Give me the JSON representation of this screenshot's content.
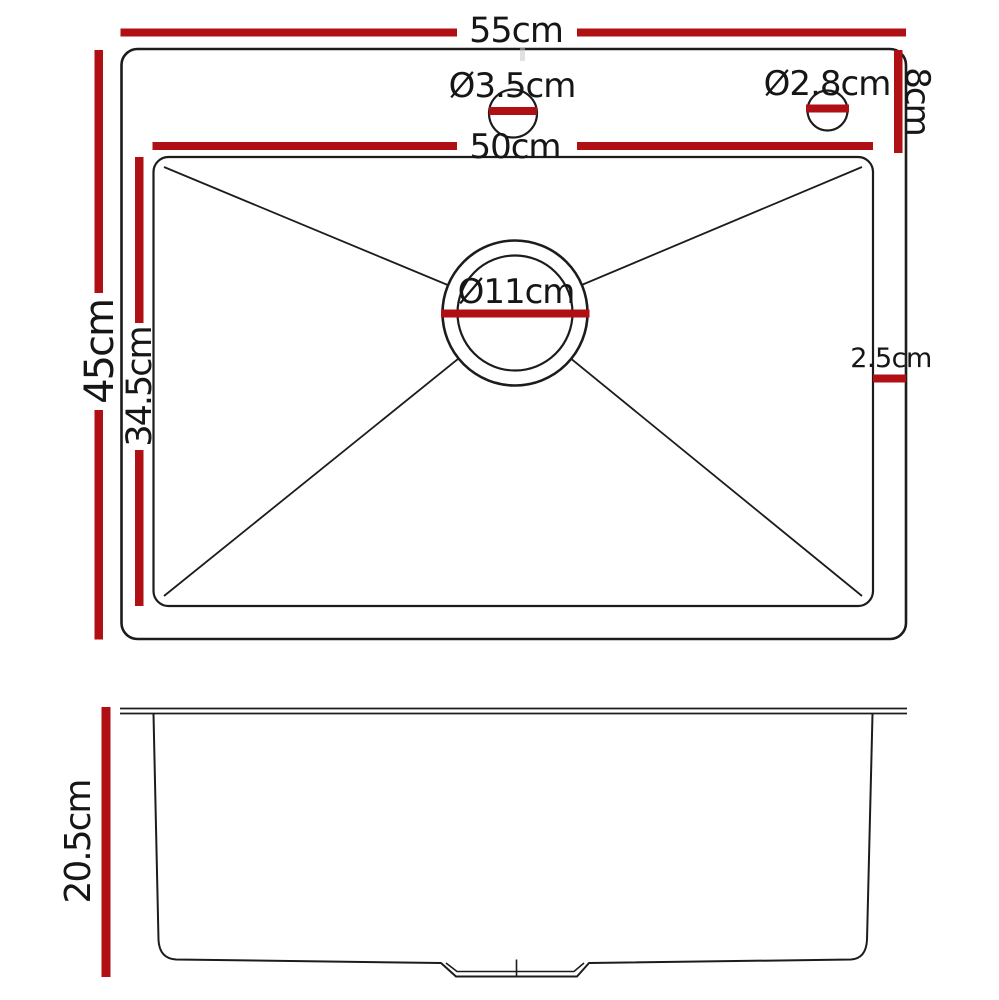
{
  "colors": {
    "dimension_red": "#b00f13",
    "outline_black": "#1c1c1c"
  },
  "top_view": {
    "labels": {
      "outer_width": "55cm",
      "inner_width": "50cm",
      "outer_depth": "45cm",
      "bowl_depth": "34.5cm",
      "tap_hole_diameter": "Ø3.5cm",
      "second_hole_diameter": "Ø2.8cm",
      "drain_diameter": "Ø11cm",
      "rear_ledge_depth": "8cm",
      "side_lip_width": "2.5cm"
    }
  },
  "side_view": {
    "labels": {
      "bowl_height": "20.5cm"
    }
  }
}
